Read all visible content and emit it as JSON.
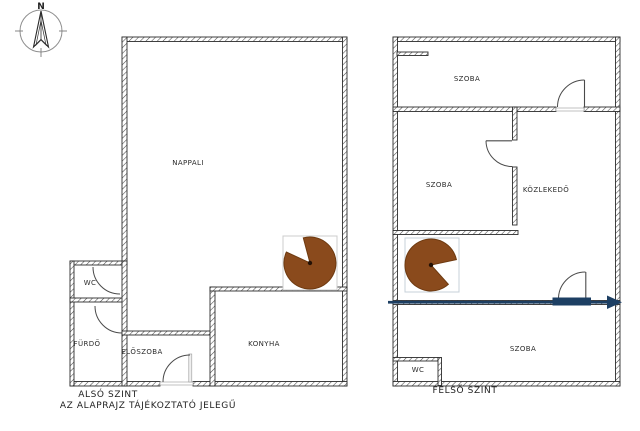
{
  "compass": {
    "label": "N"
  },
  "lower_floor": {
    "level_label": "ALSÓ SZINT",
    "disclaimer": "AZ ALAPRAJZ TÁJÉKOZTATÓ JELEGŰ",
    "rooms": {
      "nappali": {
        "label": "NAPPALI"
      },
      "wc": {
        "label": "WC"
      },
      "furdo": {
        "label": "FÜRDŐ"
      },
      "eloszoba": {
        "label": "ELŐSZOBA"
      },
      "konyha": {
        "label": "KONYHA"
      }
    }
  },
  "upper_floor": {
    "level_label": "FELSŐ SZINT",
    "rooms": {
      "szoba_top": {
        "label": "SZOBA"
      },
      "szoba_mid": {
        "label": "SZOBA"
      },
      "kozlekedo": {
        "label": "KÖZLEKEDŐ"
      },
      "szoba_bottom": {
        "label": "SZOBA"
      },
      "wc": {
        "label": "WC"
      }
    }
  },
  "colors": {
    "paper": "#ffffff",
    "wall_line": "#2c2c2c",
    "stair_fill": "#8a4a1c",
    "stair_edge": "#6e3a10",
    "stair_dot": "#241105",
    "annotation_blue": "#1d3f63"
  }
}
